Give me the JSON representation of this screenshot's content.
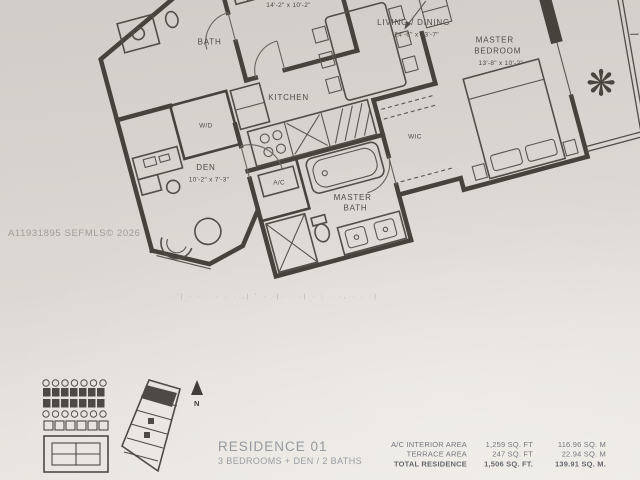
{
  "watermark": "A11931895  SEFMLS© 2026",
  "floorplan": {
    "rooms": {
      "bath": {
        "name": "BATH"
      },
      "bedroom2": {
        "name": "BEDROOM 2",
        "dims": "14'-2\" x 10'-2\""
      },
      "wd": {
        "name": "W/D"
      },
      "kitchen": {
        "name": "KITCHEN"
      },
      "den": {
        "name": "DEN",
        "dims": "10'-2\" x 7'-3\""
      },
      "ac": {
        "name": "A/C"
      },
      "master_bath": {
        "line1": "MASTER",
        "line2": "BATH"
      },
      "wic": {
        "name": "WIC"
      },
      "living": {
        "name": "LIVING / DINING",
        "dims": "24'-6\" x 13'-7\""
      },
      "master_bedroom": {
        "line1": "MASTER",
        "line2": "BEDROOM",
        "dims": "13'-8\" x 10'-2\""
      }
    },
    "disclaimer_marks": "·'| ·  ·   · ·  , · ,| '  ·  ·|· ·  ·| ·  ;  · ·,   ·      · :|"
  },
  "keyplan": {
    "north_label": "N"
  },
  "residence": {
    "title": "RESIDENCE 01",
    "subtitle": "3 BEDROOMS + DEN / 2 BATHS"
  },
  "areas": {
    "rows": [
      {
        "label": "A/C INTERIOR AREA",
        "sqft": "1,259 SQ. FT",
        "sqm": "116.96 SQ. M"
      },
      {
        "label": "TERRACE AREA",
        "sqft": "247 SQ. FT",
        "sqm": "22.94 SQ. M"
      },
      {
        "label": "TOTAL RESIDENCE",
        "sqft": "1,506 SQ. FT.",
        "sqm": "139.91 SQ. M."
      }
    ]
  },
  "colors": {
    "paper_top": "#d0ccc7",
    "paper_bottom": "#edeae5",
    "ink": "#47423c",
    "watermark_gray": "#a39c97",
    "caption_gray": "#959aa0"
  }
}
